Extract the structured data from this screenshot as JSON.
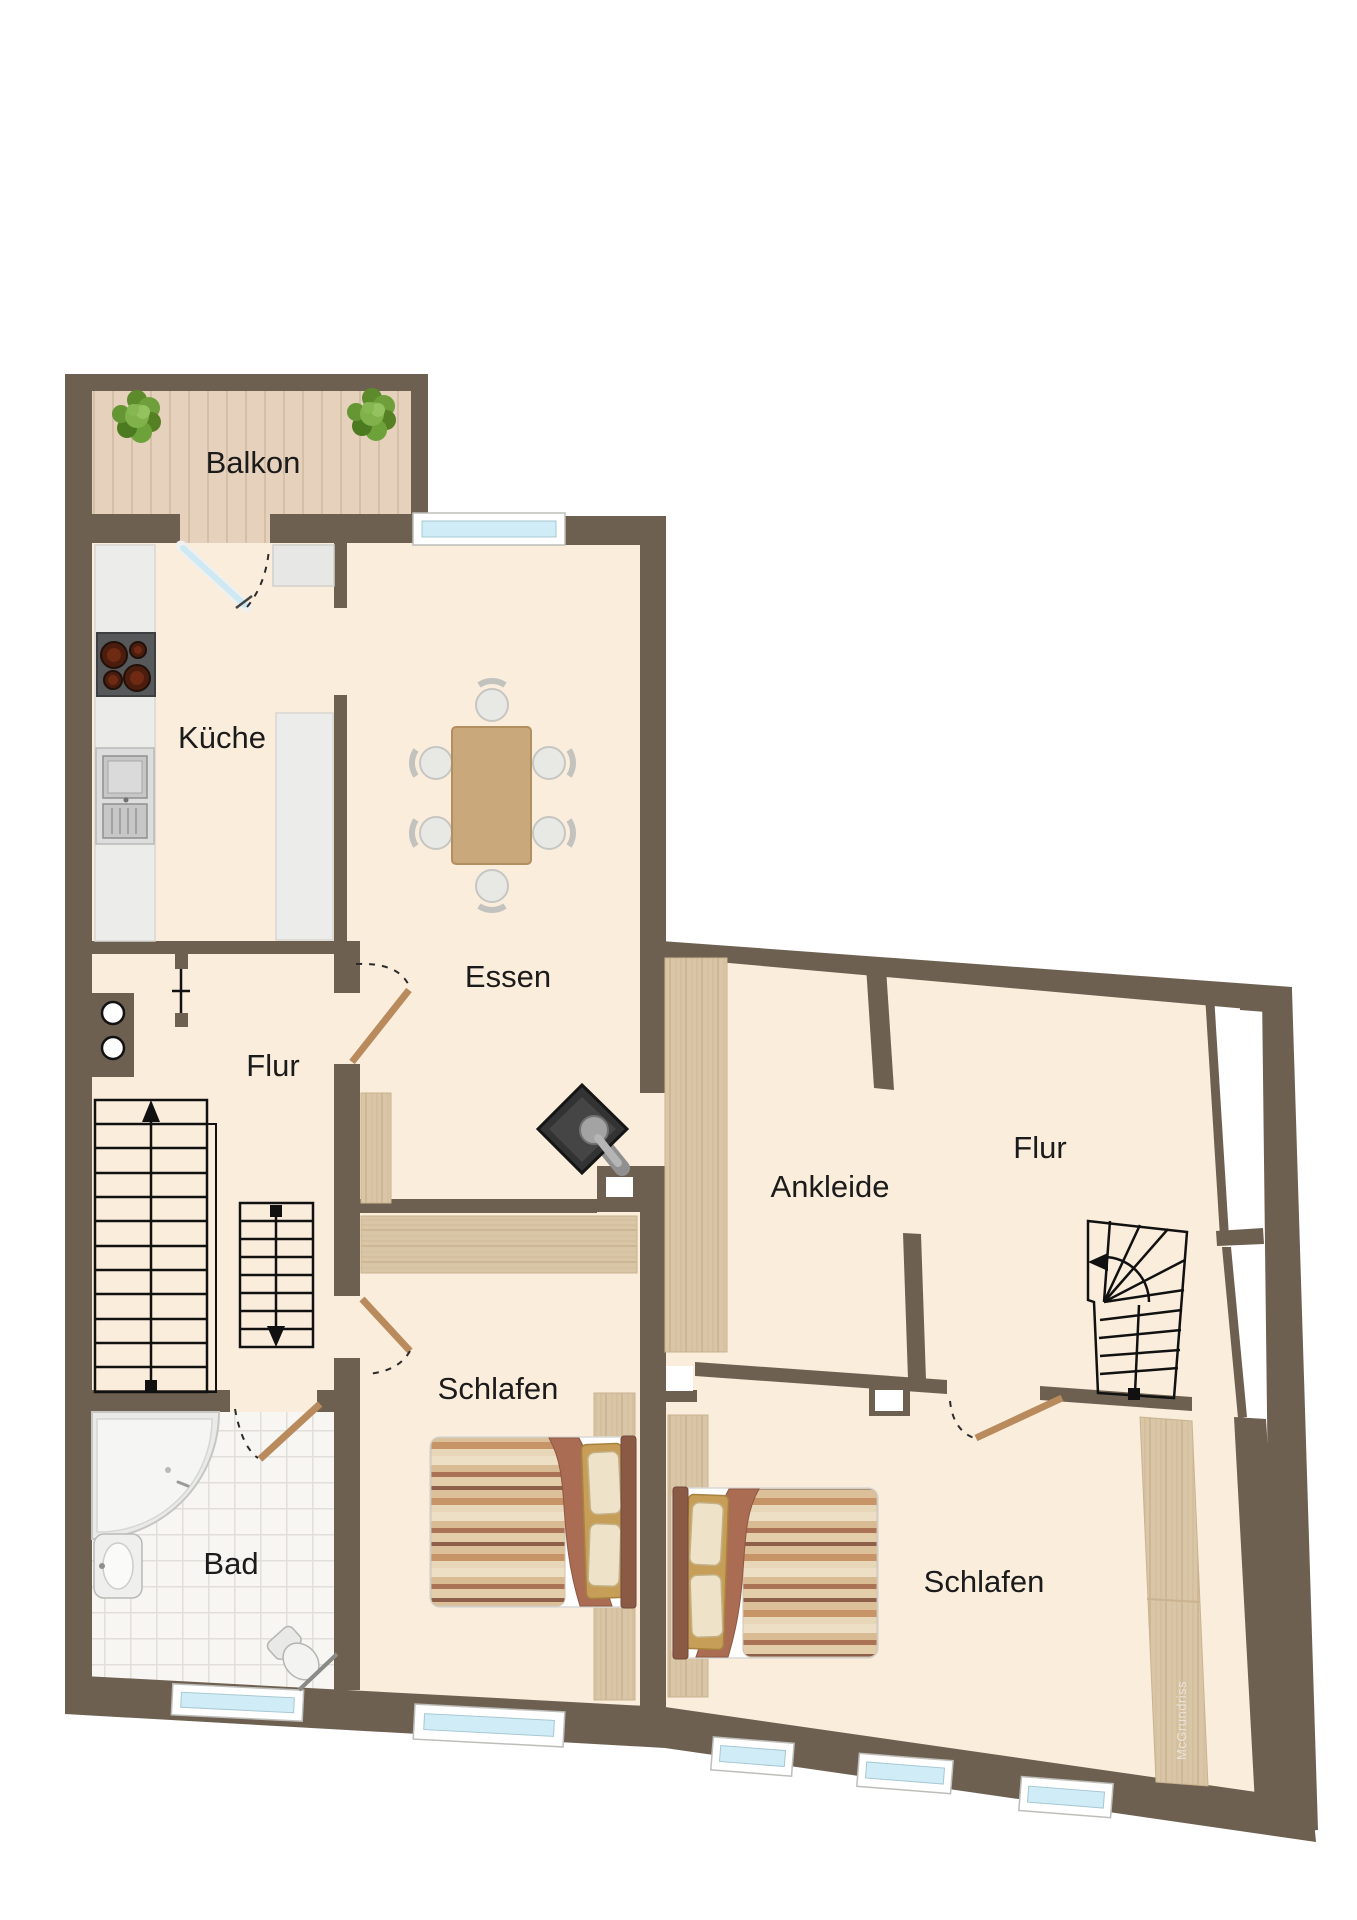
{
  "app": {
    "type": "floor-plan-viewer",
    "background": "#ffffff"
  },
  "watermark": {
    "text": "McGrundriss"
  },
  "rooms": [
    {
      "id": "balkon",
      "label": "Balkon"
    },
    {
      "id": "kueche",
      "label": "Küche"
    },
    {
      "id": "essen",
      "label": "Essen"
    },
    {
      "id": "flur",
      "label": "Flur"
    },
    {
      "id": "ankleide",
      "label": "Ankleide"
    },
    {
      "id": "flur2",
      "label": "Flur"
    },
    {
      "id": "schlafen1",
      "label": "Schlafen"
    },
    {
      "id": "bad",
      "label": "Bad"
    },
    {
      "id": "schlafen2",
      "label": "Schlafen"
    }
  ],
  "colors": {
    "wall": "#6e6051",
    "floor": "#faeddc",
    "outside": "#ffffff",
    "deck": "#e6d2bc",
    "deck_line": "#d5bfa7",
    "wood": "#d9c6a6",
    "wood_edge": "#c9b391",
    "counter": "#ececea",
    "window_glass": "#d0ecf6",
    "window_frame": "#ffffff",
    "door_wood": "#b98a5c",
    "glass_door": "#cfe9f4",
    "table": "#c9a87b",
    "chair": "#e8e8e5",
    "stove_body": "#57585a",
    "burner": "#4a1d0e",
    "fireplace": "#333333",
    "bed_base": "#fefefe",
    "blanket": "#aa6c52",
    "pillow": "#eee3c9",
    "pillow_frame": "#c79e58",
    "headboard": "#8a5a45",
    "tile": "#f7f6f3",
    "tile_line": "#e2dfd9",
    "stair_line": "#111111",
    "dash_line": "#2b2b2b",
    "label": "#1b1b1b",
    "watermark": "#e9e3d9"
  },
  "icons": {
    "plant-icon": "potted plant",
    "stove-icon": "cooktop with four burners",
    "sink-icon": "double kitchen sink",
    "dining-table-icon": "dining table with six chairs",
    "fireplace-icon": "corner wood stove with flue pipe",
    "stairs-up-icon": "straight staircase going up",
    "stairs-down-icon": "straight staircase going down",
    "winder-stairs-icon": "winder staircase",
    "bathtub-icon": "corner bathtub",
    "washbasin-icon": "washbasin",
    "toilet-icon": "toilet",
    "bed-icon": "double bed with pillows and blanket",
    "wardrobe-icon": "wardrobe / closet",
    "window-icon": "window",
    "door-icon": "door leaf with swing arc",
    "shaft-icon": "wall shaft / chimney void"
  }
}
